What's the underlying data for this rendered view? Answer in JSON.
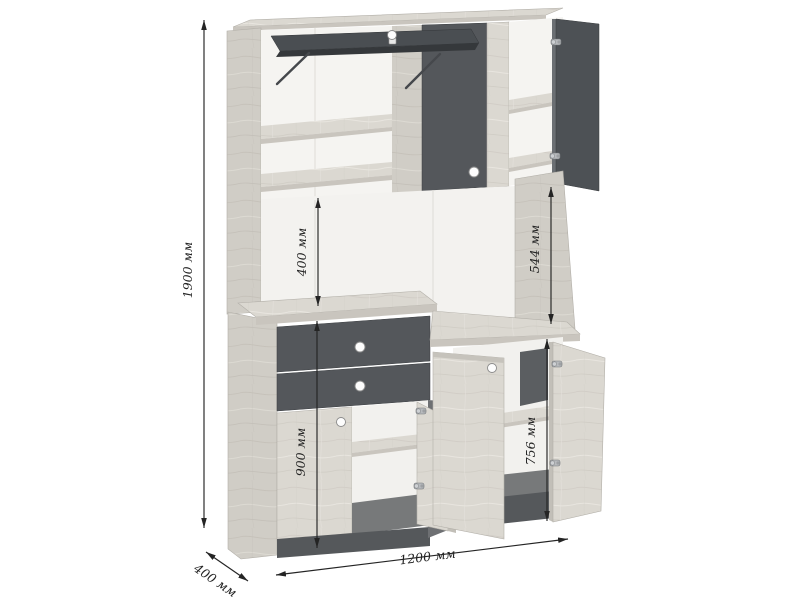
{
  "diagram": {
    "kind": "furniture-dimension-drawing",
    "object": "two-tier cabinet with open doors"
  },
  "dims": {
    "total_height": "1900 мм",
    "niche_height": "400 мм",
    "upper_inner_height": "544 мм",
    "base_height": "900 мм",
    "lower_inner_height": "756 мм",
    "width": "1200 мм",
    "depth": "400 мм"
  },
  "colors": {
    "wood": "#dbd8d1",
    "wood_shade": "#d0cdc6",
    "wood_edge": "#c9c5be",
    "dark_panel": "#54575b",
    "dark_deep": "#3f4246",
    "interior": "#f5f4f1",
    "interior_floor": "#77797a",
    "plinth": "#55585b",
    "dim_line": "#242424",
    "background": "#ffffff"
  }
}
